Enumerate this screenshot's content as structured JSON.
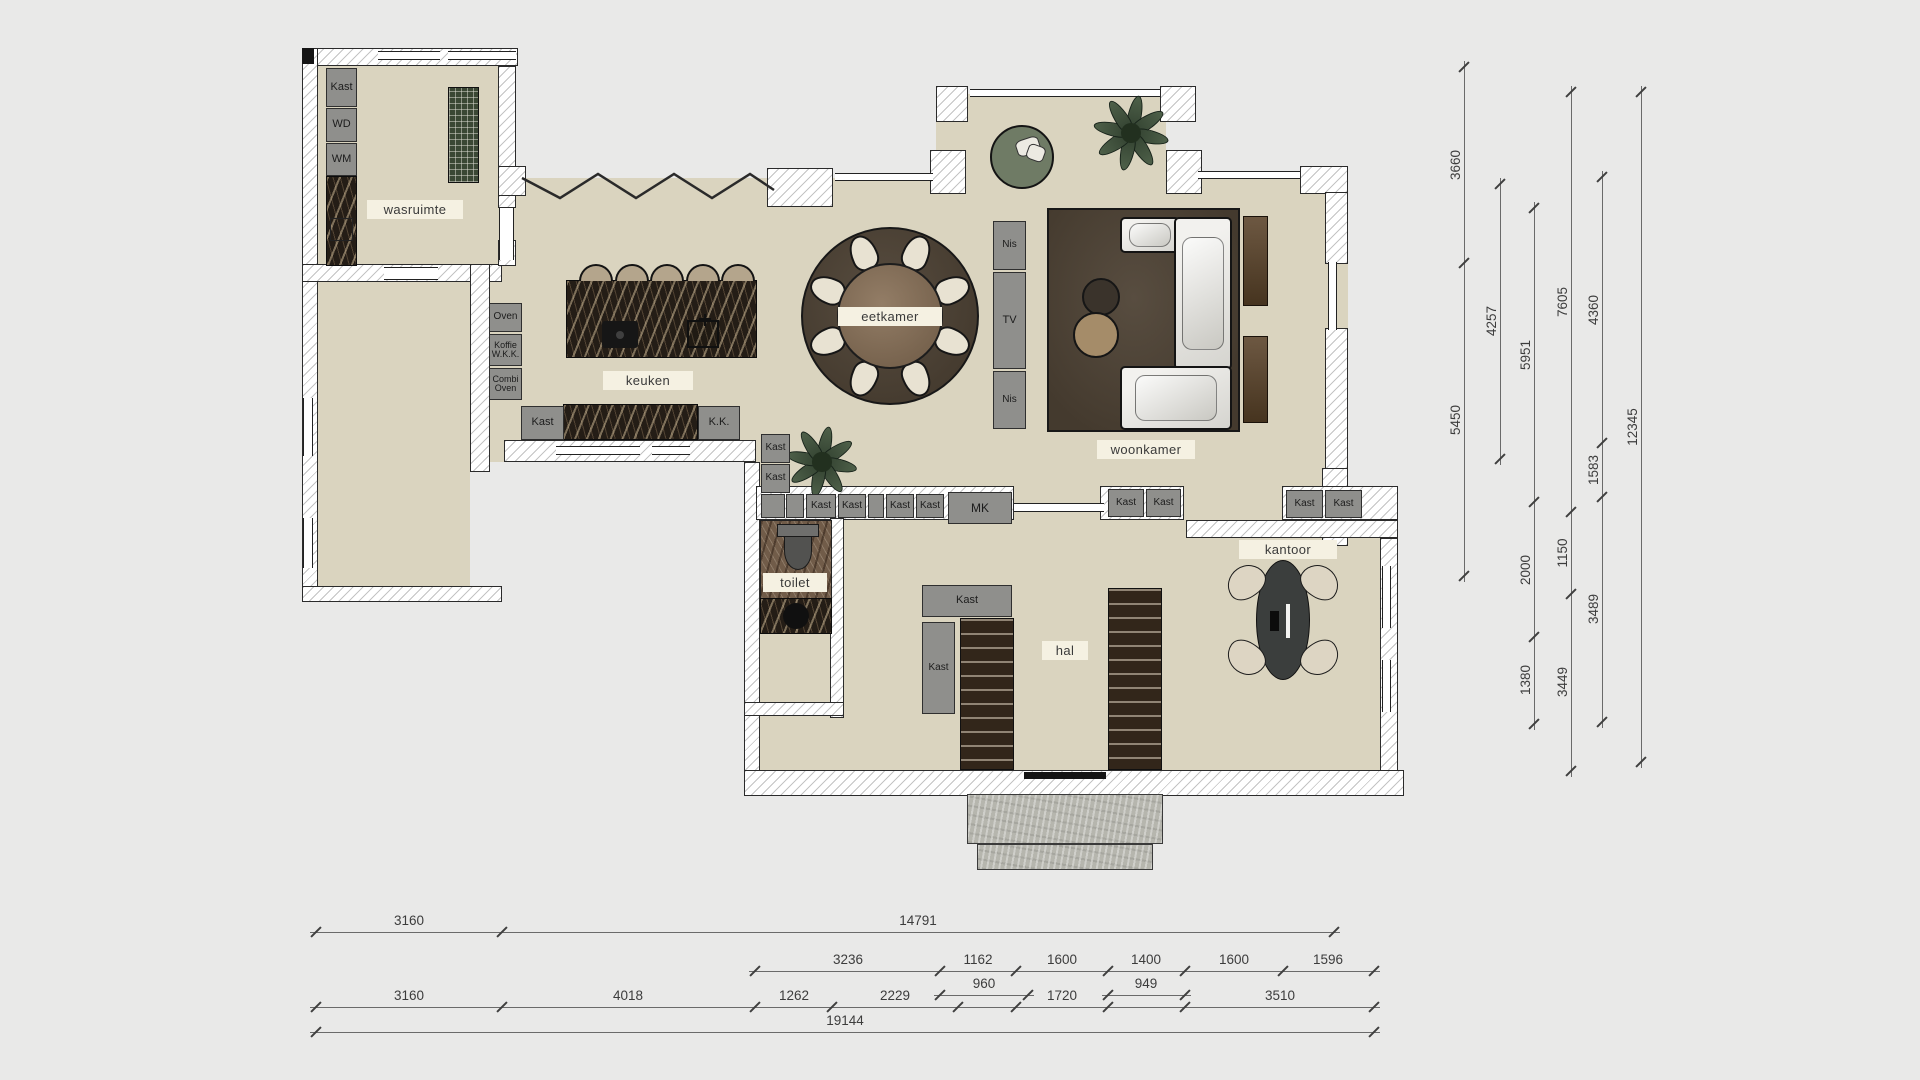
{
  "title": "floorplan",
  "colors": {
    "background": "#e9e9e8",
    "floor": "#dad4bf",
    "wall_line": "#2b2b2b",
    "fixture_gray": "#8f8f8c",
    "chip_bg": "#f5f1e2",
    "rug_brown": "#4a4035",
    "marble_dark": "#241d16",
    "plant_green": "#4e6049",
    "dim_text": "#3c3c3c"
  },
  "floors": [
    {
      "x": 318,
      "y": 66,
      "w": 182,
      "h": 200
    },
    {
      "x": 318,
      "y": 282,
      "w": 152,
      "h": 304
    },
    {
      "x": 488,
      "y": 178,
      "w": 860,
      "h": 284
    },
    {
      "x": 744,
      "y": 462,
      "w": 604,
      "h": 24
    },
    {
      "x": 936,
      "y": 94,
      "w": 230,
      "h": 90
    },
    {
      "x": 752,
      "y": 486,
      "w": 630,
      "h": 284
    }
  ],
  "walls": [
    {
      "x": 302,
      "y": 48,
      "w": 216,
      "h": 18
    },
    {
      "x": 302,
      "y": 48,
      "w": 16,
      "h": 554
    },
    {
      "x": 302,
      "y": 264,
      "w": 200,
      "h": 18
    },
    {
      "x": 302,
      "y": 586,
      "w": 200,
      "h": 16
    },
    {
      "x": 498,
      "y": 66,
      "w": 18,
      "h": 142
    },
    {
      "x": 498,
      "y": 240,
      "w": 18,
      "h": 26
    },
    {
      "x": 470,
      "y": 264,
      "w": 20,
      "h": 208
    },
    {
      "x": 498,
      "y": 166,
      "w": 28,
      "h": 30
    },
    {
      "x": 767,
      "y": 168,
      "w": 66,
      "h": 39
    },
    {
      "x": 936,
      "y": 86,
      "w": 32,
      "h": 36
    },
    {
      "x": 930,
      "y": 150,
      "w": 36,
      "h": 44
    },
    {
      "x": 1160,
      "y": 86,
      "w": 36,
      "h": 36
    },
    {
      "x": 1166,
      "y": 150,
      "w": 36,
      "h": 44
    },
    {
      "x": 1300,
      "y": 166,
      "w": 48,
      "h": 28
    },
    {
      "x": 1325,
      "y": 192,
      "w": 23,
      "h": 72
    },
    {
      "x": 1325,
      "y": 328,
      "w": 23,
      "h": 142
    },
    {
      "x": 1322,
      "y": 468,
      "w": 26,
      "h": 78
    },
    {
      "x": 504,
      "y": 440,
      "w": 252,
      "h": 22
    },
    {
      "x": 744,
      "y": 462,
      "w": 16,
      "h": 310
    },
    {
      "x": 756,
      "y": 486,
      "w": 258,
      "h": 34
    },
    {
      "x": 1100,
      "y": 486,
      "w": 84,
      "h": 34
    },
    {
      "x": 1282,
      "y": 486,
      "w": 116,
      "h": 34
    },
    {
      "x": 1186,
      "y": 520,
      "w": 212,
      "h": 18
    },
    {
      "x": 1380,
      "y": 538,
      "w": 18,
      "h": 234
    },
    {
      "x": 744,
      "y": 770,
      "w": 660,
      "h": 26
    },
    {
      "x": 830,
      "y": 518,
      "w": 14,
      "h": 200
    },
    {
      "x": 744,
      "y": 702,
      "w": 100,
      "h": 14
    }
  ],
  "windows": [
    {
      "x": 378,
      "y": 51,
      "w": 62,
      "h": 9
    },
    {
      "x": 448,
      "y": 51,
      "w": 68,
      "h": 9
    },
    {
      "x": 303,
      "y": 398,
      "w": 10,
      "h": 58,
      "v": true
    },
    {
      "x": 303,
      "y": 518,
      "w": 10,
      "h": 50,
      "v": true
    },
    {
      "x": 970,
      "y": 89,
      "w": 190,
      "h": 8
    },
    {
      "x": 1198,
      "y": 171,
      "w": 102,
      "h": 8
    },
    {
      "x": 835,
      "y": 173,
      "w": 98,
      "h": 8
    },
    {
      "x": 1328,
      "y": 262,
      "w": 9,
      "h": 68,
      "v": true
    },
    {
      "x": 556,
      "y": 446,
      "w": 84,
      "h": 9
    },
    {
      "x": 652,
      "y": 446,
      "w": 38,
      "h": 9
    },
    {
      "x": 1014,
      "y": 503,
      "w": 90,
      "h": 9
    },
    {
      "x": 1382,
      "y": 566,
      "w": 9,
      "h": 62,
      "v": true
    },
    {
      "x": 1382,
      "y": 660,
      "w": 9,
      "h": 52,
      "v": true
    },
    {
      "x": 499,
      "y": 208,
      "w": 15,
      "h": 52,
      "v": true
    },
    {
      "x": 384,
      "y": 267,
      "w": 54,
      "h": 13
    }
  ],
  "zigzag": {
    "x": 518,
    "y": 160,
    "w": 260,
    "h": 46,
    "points": "4,18 42,38 80,14 118,38 156,14 194,38 232,14 256,30"
  },
  "fixtures": [
    {
      "label": "Kast",
      "x": 326,
      "y": 68,
      "w": 31,
      "h": 39
    },
    {
      "label": "WD",
      "x": 326,
      "y": 108,
      "w": 31,
      "h": 34
    },
    {
      "label": "WM",
      "x": 326,
      "y": 143,
      "w": 31,
      "h": 33
    },
    {
      "label": "Oven",
      "x": 489,
      "y": 303,
      "w": 33,
      "h": 29,
      "fs": 10
    },
    {
      "label": "Koffie\nW.K.K.",
      "x": 489,
      "y": 334,
      "w": 33,
      "h": 32,
      "fs": 9
    },
    {
      "label": "Combi\nOven",
      "x": 489,
      "y": 368,
      "w": 33,
      "h": 32,
      "fs": 9
    },
    {
      "label": "Kast",
      "x": 521,
      "y": 406,
      "w": 43,
      "h": 34
    },
    {
      "label": "K.K.",
      "x": 698,
      "y": 406,
      "w": 42,
      "h": 34
    },
    {
      "label": "Nis",
      "x": 993,
      "y": 221,
      "w": 33,
      "h": 49,
      "fs": 10
    },
    {
      "label": "TV",
      "x": 993,
      "y": 272,
      "w": 33,
      "h": 97
    },
    {
      "label": "Nis",
      "x": 993,
      "y": 371,
      "w": 33,
      "h": 58,
      "fs": 10
    },
    {
      "label": "Kast",
      "x": 761,
      "y": 434,
      "w": 29,
      "h": 29,
      "fs": 10
    },
    {
      "label": "Kast",
      "x": 761,
      "y": 464,
      "w": 29,
      "h": 29,
      "fs": 10
    },
    {
      "label": "",
      "x": 761,
      "y": 494,
      "w": 24,
      "h": 24
    },
    {
      "label": "",
      "x": 786,
      "y": 494,
      "w": 18,
      "h": 24
    },
    {
      "label": "Kast",
      "x": 806,
      "y": 494,
      "w": 30,
      "h": 24,
      "fs": 10
    },
    {
      "label": "Kast",
      "x": 838,
      "y": 494,
      "w": 28,
      "h": 24,
      "fs": 10
    },
    {
      "label": "",
      "x": 868,
      "y": 494,
      "w": 16,
      "h": 24
    },
    {
      "label": "Kast",
      "x": 886,
      "y": 494,
      "w": 28,
      "h": 24,
      "fs": 10
    },
    {
      "label": "Kast",
      "x": 916,
      "y": 494,
      "w": 28,
      "h": 24,
      "fs": 10
    },
    {
      "label": "MK",
      "x": 948,
      "y": 492,
      "w": 64,
      "h": 32,
      "fs": 12
    },
    {
      "label": "Kast",
      "x": 1108,
      "y": 489,
      "w": 36,
      "h": 28,
      "fs": 10
    },
    {
      "label": "Kast",
      "x": 1146,
      "y": 489,
      "w": 35,
      "h": 28,
      "fs": 10
    },
    {
      "label": "Kast",
      "x": 1286,
      "y": 490,
      "w": 37,
      "h": 28,
      "fs": 10
    },
    {
      "label": "Kast",
      "x": 1325,
      "y": 490,
      "w": 37,
      "h": 28,
      "fs": 10
    },
    {
      "label": "Kast",
      "x": 922,
      "y": 585,
      "w": 90,
      "h": 32
    },
    {
      "label": "Kast",
      "x": 922,
      "y": 622,
      "w": 33,
      "h": 92,
      "fs": 10
    }
  ],
  "chips": [
    {
      "label": "wasruimte",
      "cx": 415,
      "cy": 209,
      "w": 96,
      "h": 19
    },
    {
      "label": "keuken",
      "cx": 648,
      "cy": 380,
      "w": 90,
      "h": 19
    },
    {
      "label": "eetkamer",
      "cx": 890,
      "cy": 316,
      "w": 104,
      "h": 19
    },
    {
      "label": "woonkamer",
      "cx": 1146,
      "cy": 449,
      "w": 98,
      "h": 19
    },
    {
      "label": "toilet",
      "cx": 795,
      "cy": 582,
      "w": 64,
      "h": 19
    },
    {
      "label": "hal",
      "cx": 1065,
      "cy": 650,
      "w": 46,
      "h": 19
    },
    {
      "label": "kantoor",
      "cx": 1288,
      "cy": 549,
      "w": 98,
      "h": 19
    }
  ],
  "furniture": [
    {
      "type": "solid",
      "x": 302,
      "y": 48,
      "w": 12,
      "h": 16
    },
    {
      "type": "marble",
      "x": 326,
      "y": 176,
      "w": 31,
      "h": 90
    },
    {
      "type": "outline",
      "x": 330,
      "y": 218,
      "w": 23,
      "h": 23
    },
    {
      "type": "rack",
      "x": 448,
      "y": 87,
      "w": 31,
      "h": 96
    },
    {
      "type": "marble",
      "x": 566,
      "y": 280,
      "w": 191,
      "h": 78
    },
    {
      "type": "hob",
      "x": 602,
      "y": 321,
      "w": 36,
      "h": 27
    },
    {
      "type": "sink",
      "x": 687,
      "y": 320,
      "w": 32,
      "h": 28
    },
    {
      "type": "stools",
      "cy": 264,
      "r": 17,
      "cx": [
        596,
        632,
        667,
        703,
        738
      ]
    },
    {
      "type": "marble",
      "x": 563,
      "y": 404,
      "w": 135,
      "h": 36
    },
    {
      "type": "round-rug",
      "cx": 890,
      "cy": 316,
      "r": 89
    },
    {
      "type": "dining-chairs",
      "cx": 890,
      "cy": 316,
      "r": 68,
      "count": 8
    },
    {
      "type": "round-table",
      "cx": 890,
      "cy": 316,
      "r": 53
    },
    {
      "type": "rug",
      "x": 1047,
      "y": 208,
      "w": 193,
      "h": 224
    },
    {
      "type": "sofa",
      "x": 1120,
      "y": 217,
      "w": 60,
      "h": 36
    },
    {
      "type": "sofa",
      "x": 1174,
      "y": 217,
      "w": 58,
      "h": 153
    },
    {
      "type": "sofa",
      "x": 1120,
      "y": 366,
      "w": 112,
      "h": 64
    },
    {
      "type": "pouf",
      "cx": 1101,
      "cy": 297,
      "r": 19,
      "color": "#3a332b"
    },
    {
      "type": "pouf",
      "cx": 1096,
      "cy": 335,
      "r": 23,
      "color": "#a58c69"
    },
    {
      "type": "sideboard",
      "x": 1243,
      "y": 216,
      "w": 25,
      "h": 90
    },
    {
      "type": "sideboard",
      "x": 1243,
      "y": 336,
      "w": 25,
      "h": 87
    },
    {
      "type": "round-chair",
      "cx": 1022,
      "cy": 157,
      "r": 32
    },
    {
      "type": "plant",
      "cx": 1131,
      "cy": 133,
      "r": 34
    },
    {
      "type": "plant",
      "cx": 822,
      "cy": 462,
      "r": 32
    },
    {
      "type": "marble-floor",
      "x": 760,
      "y": 520,
      "w": 72,
      "h": 114
    },
    {
      "type": "toilet",
      "x": 777,
      "y": 524,
      "w": 42,
      "h": 46
    },
    {
      "type": "marble",
      "x": 760,
      "y": 598,
      "w": 72,
      "h": 36
    },
    {
      "type": "basin",
      "cx": 796,
      "cy": 616,
      "r": 13
    },
    {
      "type": "stairs",
      "x": 960,
      "y": 618,
      "w": 54,
      "h": 152
    },
    {
      "type": "stairs",
      "x": 1108,
      "y": 588,
      "w": 54,
      "h": 182
    },
    {
      "type": "desk",
      "cx": 1283,
      "cy": 620,
      "rx": 27,
      "ry": 60
    },
    {
      "type": "office-chair",
      "cx": 1246,
      "cy": 582,
      "rot": -35
    },
    {
      "type": "office-chair",
      "cx": 1320,
      "cy": 582,
      "rot": 35
    },
    {
      "type": "office-chair",
      "cx": 1246,
      "cy": 658,
      "rot": -145
    },
    {
      "type": "office-chair",
      "cx": 1320,
      "cy": 658,
      "rot": 145
    },
    {
      "type": "porch",
      "x": 967,
      "y": 794,
      "w": 196,
      "h": 50
    },
    {
      "type": "porch",
      "x": 977,
      "y": 844,
      "w": 176,
      "h": 26
    },
    {
      "type": "solid",
      "x": 1024,
      "y": 772,
      "w": 82,
      "h": 7
    }
  ],
  "dims": {
    "right": [
      {
        "x": 1464,
        "ticks": [
          67,
          263,
          576
        ],
        "labels": [
          {
            "t": "3660",
            "y": 165
          },
          {
            "t": "5450",
            "y": 420
          }
        ]
      },
      {
        "x": 1500,
        "ticks": [
          184,
          459
        ],
        "labels": [
          {
            "t": "4257",
            "y": 321
          }
        ]
      },
      {
        "x": 1534,
        "ticks": [
          208,
          502,
          637,
          724
        ],
        "labels": [
          {
            "t": "5951",
            "y": 355
          },
          {
            "t": "2000",
            "y": 570
          },
          {
            "t": "1380",
            "y": 680
          }
        ]
      },
      {
        "x": 1571,
        "ticks": [
          92,
          512,
          594,
          771
        ],
        "labels": [
          {
            "t": "7605",
            "y": 302
          },
          {
            "t": "1150",
            "y": 553
          },
          {
            "t": "3449",
            "y": 682
          }
        ]
      },
      {
        "x": 1602,
        "ticks": [
          177,
          443,
          497,
          722
        ],
        "labels": [
          {
            "t": "4360",
            "y": 310
          },
          {
            "t": "1583",
            "y": 470
          },
          {
            "t": "3489",
            "y": 609
          }
        ]
      },
      {
        "x": 1641,
        "ticks": [
          92,
          762
        ],
        "labels": [
          {
            "t": "12345",
            "y": 427
          }
        ]
      }
    ],
    "bottom": [
      {
        "y": 932,
        "ticks": [
          316,
          502,
          1334
        ],
        "labels": [
          {
            "t": "3160",
            "x": 409
          },
          {
            "t": "14791",
            "x": 918
          }
        ]
      },
      {
        "y": 971,
        "ticks": [
          755,
          940,
          1016,
          1108,
          1185,
          1283,
          1374
        ],
        "labels": [
          {
            "t": "3236",
            "x": 848
          },
          {
            "t": "1162",
            "x": 978
          },
          {
            "t": "1600",
            "x": 1062
          },
          {
            "t": "1400",
            "x": 1146
          },
          {
            "t": "1600",
            "x": 1234
          },
          {
            "t": "1596",
            "x": 1328
          }
        ]
      },
      {
        "y": 995,
        "ticks": [
          940,
          1028
        ],
        "labels": [
          {
            "t": "960",
            "x": 984
          }
        ]
      },
      {
        "y": 995,
        "ticks": [
          1108,
          1185
        ],
        "labels": [
          {
            "t": "949",
            "x": 1146
          }
        ]
      },
      {
        "y": 1007,
        "ticks": [
          316,
          502,
          755,
          832,
          958,
          1016,
          1108,
          1185,
          1374
        ],
        "labels": [
          {
            "t": "3160",
            "x": 409
          },
          {
            "t": "4018",
            "x": 628
          },
          {
            "t": "1262",
            "x": 794
          },
          {
            "t": "2229",
            "x": 895
          },
          {
            "t": "1720",
            "x": 1062
          },
          {
            "t": "3510",
            "x": 1280
          }
        ]
      },
      {
        "y": 1032,
        "ticks": [
          316,
          1374
        ],
        "labels": [
          {
            "t": "19144",
            "x": 845
          }
        ]
      }
    ]
  }
}
